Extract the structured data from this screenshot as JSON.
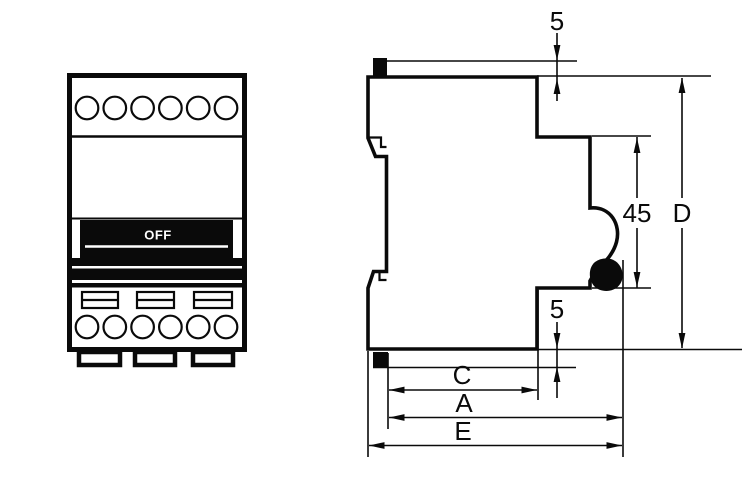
{
  "drawing": {
    "type": "circuit-breaker outline drawing, front view and side view",
    "colors": {
      "line": "#0a0a0a",
      "background": "#ffffff",
      "toggle_handle_fill": "#0a0a0a",
      "toggle_text": "#ffffff"
    },
    "front_view": {
      "switch_label": "OFF",
      "top_terminal_count": 6,
      "bottom_terminal_count": 6,
      "vent_slot_count": 3,
      "mounting_foot_count": 3
    },
    "side_view": {
      "dimensions": {
        "top_clearance": "5",
        "handle_height": "45",
        "overall_height": "D",
        "bottom_clearance": "5",
        "body_depth": "C",
        "depth_with_handle": "A",
        "overall_depth": "E"
      }
    }
  }
}
